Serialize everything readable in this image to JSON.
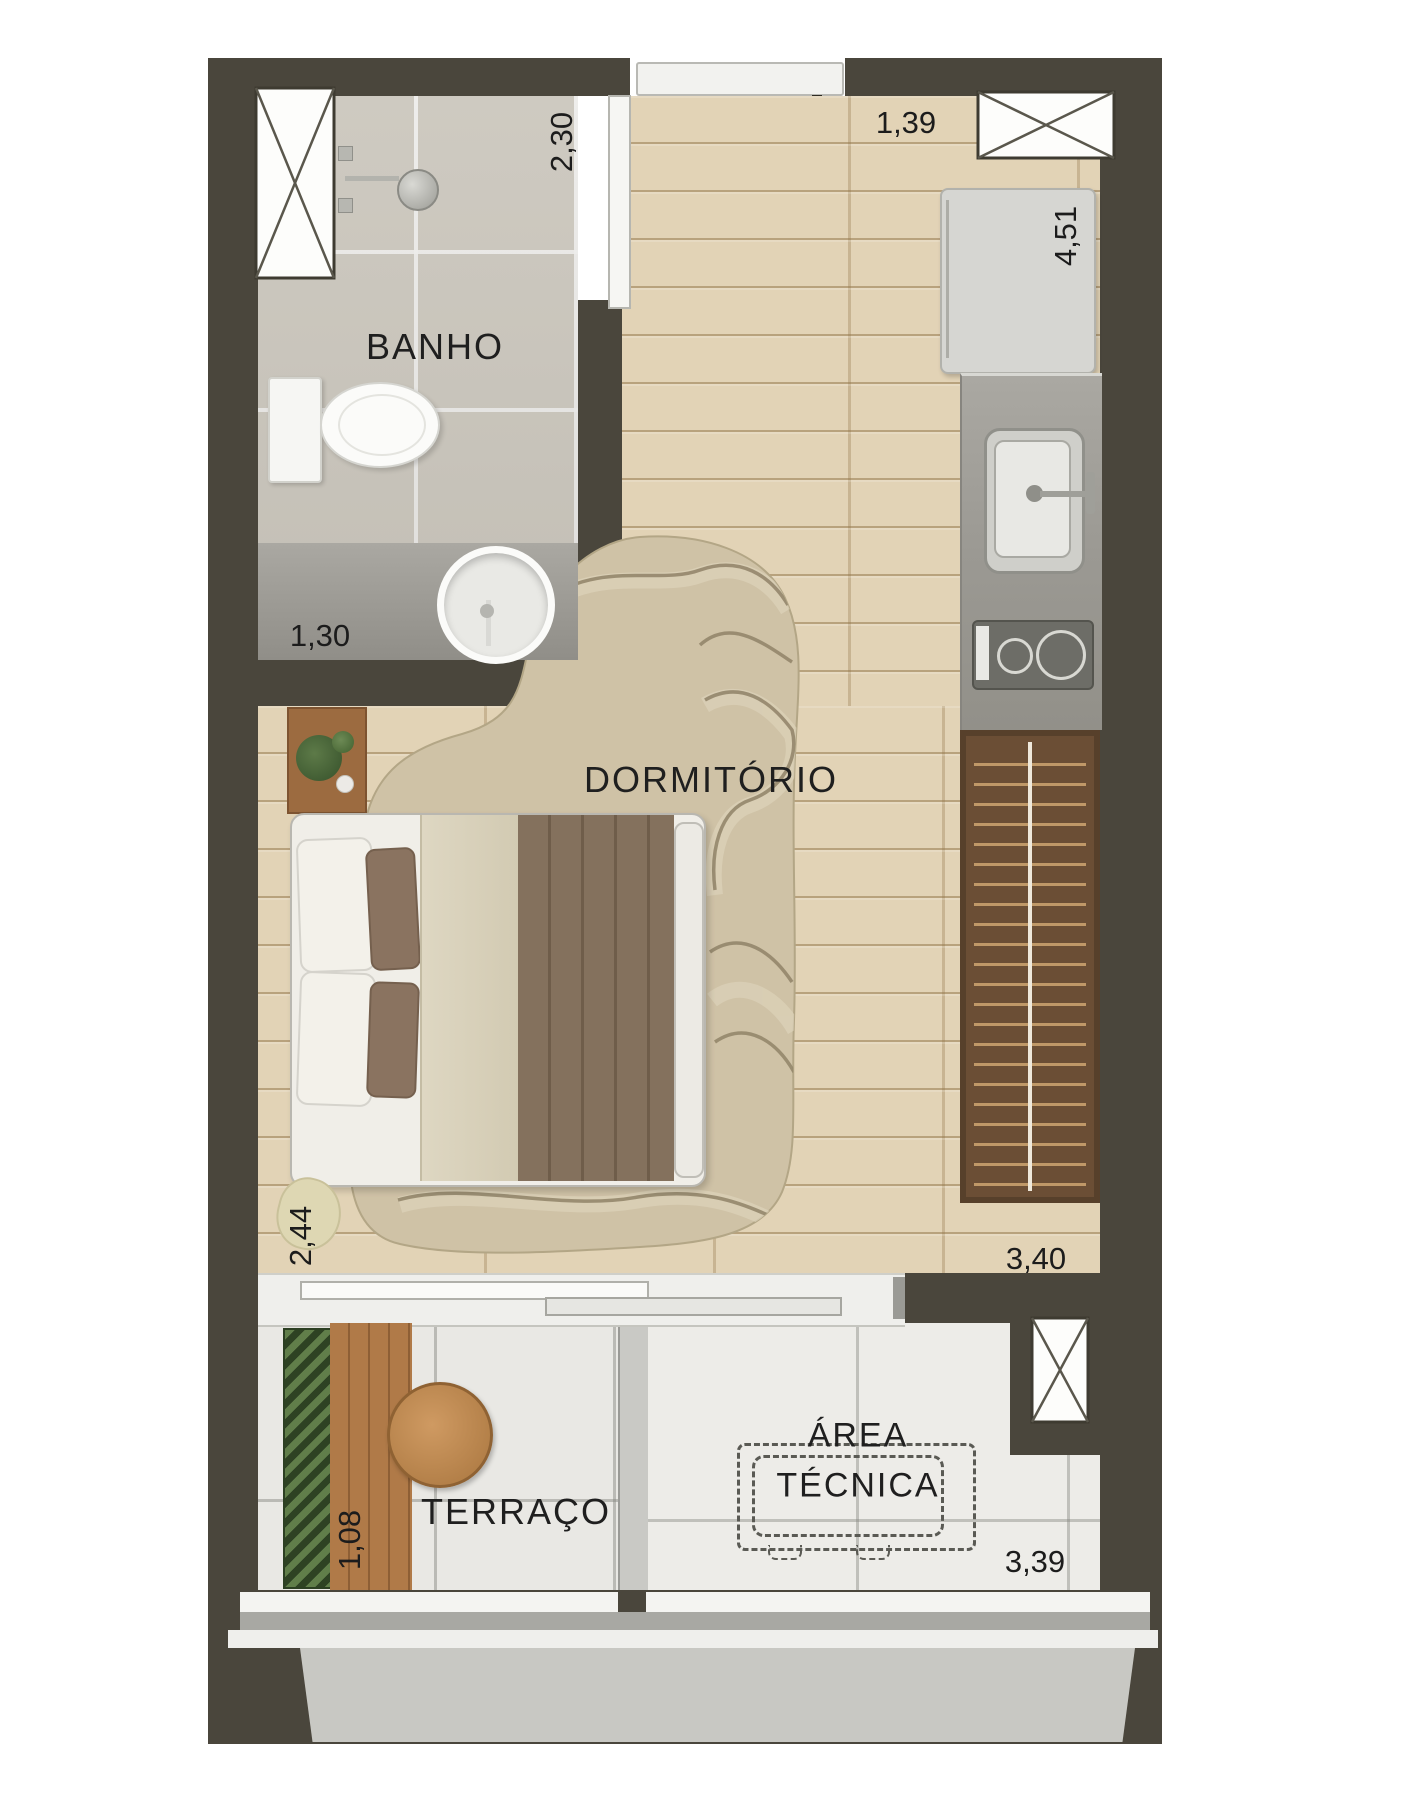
{
  "title": "Studio apartment floor plan",
  "rooms": {
    "banho": "BANHO",
    "dormitorio": "DORMITÓRIO",
    "terraco": "TERRAÇO",
    "area_tecnica_1": "ÁREA",
    "area_tecnica_2": "TÉCNICA"
  },
  "dims": {
    "banho_w": "2,30",
    "entry_w": "1,39",
    "right_h": "4,51",
    "banho_d": "1,30",
    "dorm_w": "2,44",
    "dorm_l": "3,40",
    "terr_d": "1,08",
    "at_w": "3,39"
  },
  "colors": {
    "wall": "#4a463c",
    "wood_floor": "#e2d3b6",
    "bath_tile": "#d8d4cb",
    "terrace_tile": "#e9e8e4",
    "counter": "#a5a39d",
    "wardrobe_wood": "#6b4e35",
    "deck_wood": "#b07a48",
    "rug": "#cfc2a6",
    "duvet": "#84715d",
    "plant_green": "#3d5430",
    "text": "#1f1f1f"
  },
  "fixtures": {
    "shafts": 3,
    "note": "shaft boxes drawn with X cross"
  }
}
